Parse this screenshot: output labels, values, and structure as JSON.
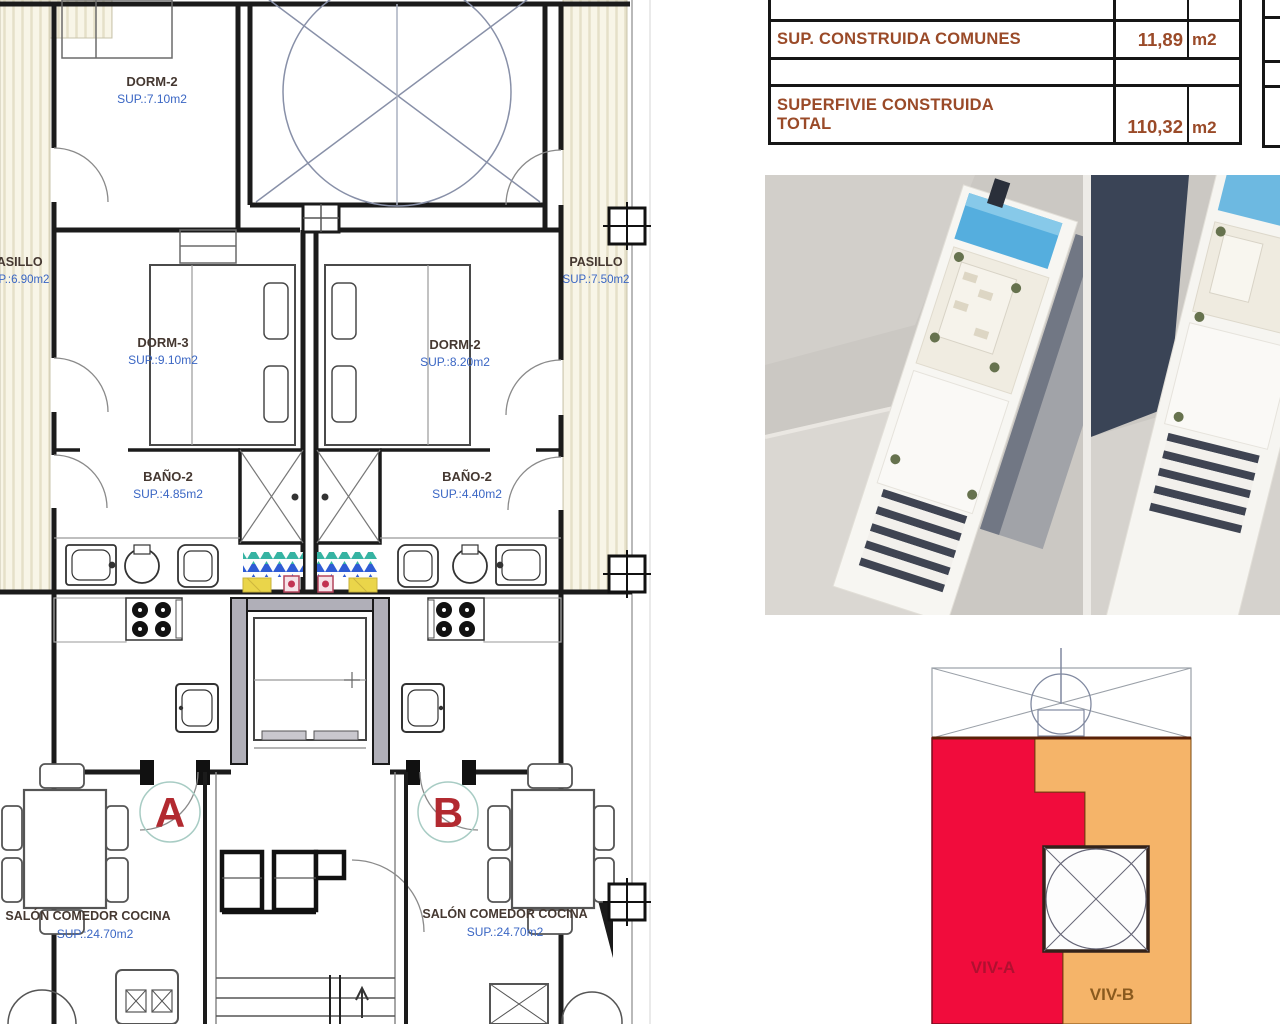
{
  "document": {
    "type": "architectural floor plan sheet",
    "colors": {
      "table_text": "#9A4A28",
      "room_label": "#453831",
      "sup_label_blue": "#3A66C4",
      "unit_letter_red": "#B22A30",
      "viv_a_red": "#F10C3C",
      "viv_b_orange": "#F5B469",
      "mosaic_teal": "#35B3A2",
      "mosaic_blue": "#2E5BD4",
      "mosaic_yellow": "#EAD54A",
      "pool_blue": "#55AEDE",
      "hatch_cream": "#F8F5E7"
    }
  },
  "summary_table": {
    "rows": [
      {
        "label": "SUP. CONSTRUIDA COMUNES",
        "value": "11,89",
        "unit": "m2"
      },
      {
        "label_line1": "SUPERFIVIE CONSTRUIDA",
        "label_line2": "TOTAL",
        "value": "110,32",
        "unit": "m2"
      }
    ]
  },
  "floor_plan": {
    "rooms": {
      "dorm2_top": {
        "name": "DORM-2",
        "sup": "SUP.:7.10m2"
      },
      "pasillo_left": {
        "name": "PASILLO",
        "sup": "SUP.:6.90m2"
      },
      "pasillo_right": {
        "name": "PASILLO",
        "sup": "SUP.:7.50m2"
      },
      "dorm3": {
        "name": "DORM-3",
        "sup": "SUP.:9.10m2"
      },
      "dorm2_right": {
        "name": "DORM-2",
        "sup": "SUP.:8.20m2"
      },
      "bano2_left": {
        "name": "BAÑO-2",
        "sup": "SUP.:4.85m2"
      },
      "bano2_right": {
        "name": "BAÑO-2",
        "sup": "SUP.:4.40m2"
      },
      "salon_left": {
        "name": "SALÓN COMEDOR COCINA",
        "sup": "SUP.:24.70m2"
      },
      "salon_right": {
        "name": "SALÓN COMEDOR COCINA",
        "sup": "SUP.:24.70m2"
      }
    },
    "units": {
      "a": "A",
      "b": "B"
    }
  },
  "key_plan": {
    "labels": {
      "viv_a": "VIV-A",
      "viv_b": "VIV-B"
    }
  }
}
